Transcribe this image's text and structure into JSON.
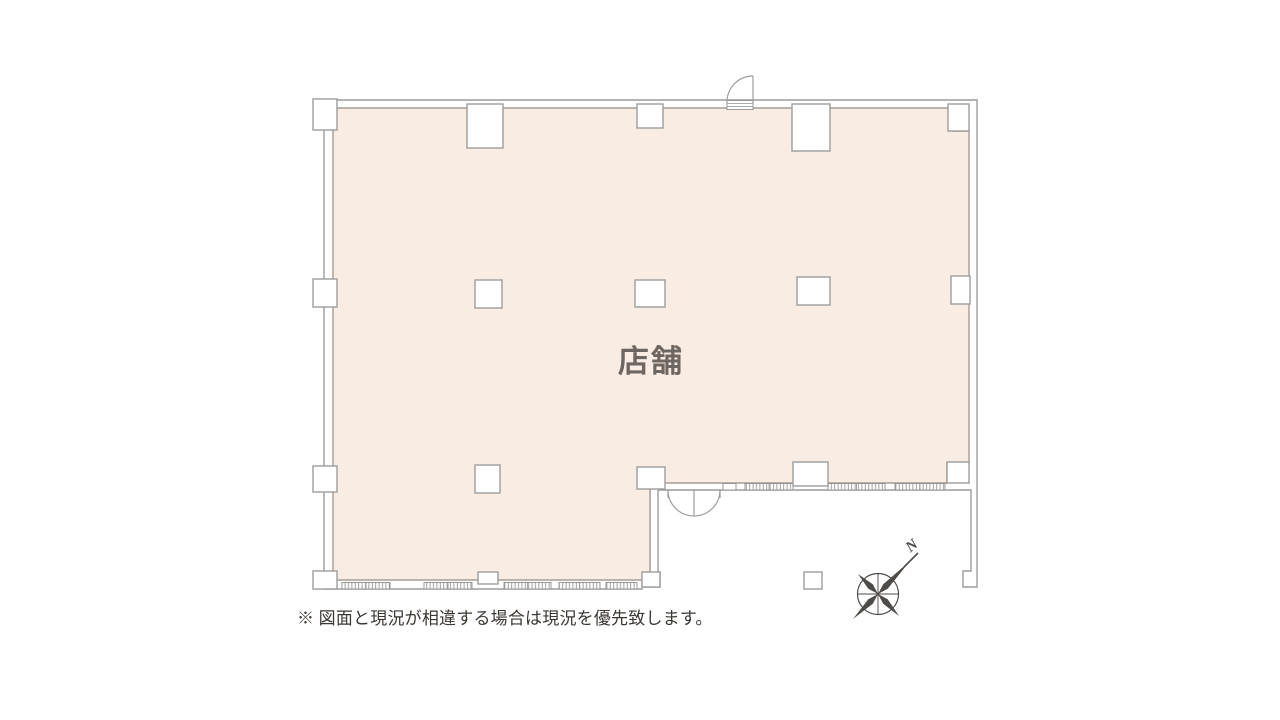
{
  "floor_plan": {
    "title_label": "店舗",
    "footnote": "※ 図面と現況が相違する場合は現況を優先致します。",
    "compass_label": "N",
    "colors": {
      "floor_fill": "#f9ece2",
      "floor_border": "#a49d96",
      "wall_line": "#9c9c9c",
      "window_line": "#8f8f8f",
      "label_text": "#6e6761",
      "note_text": "#3b3733",
      "compass": "#4f4b49",
      "page_bg": "#ffffff"
    }
  }
}
